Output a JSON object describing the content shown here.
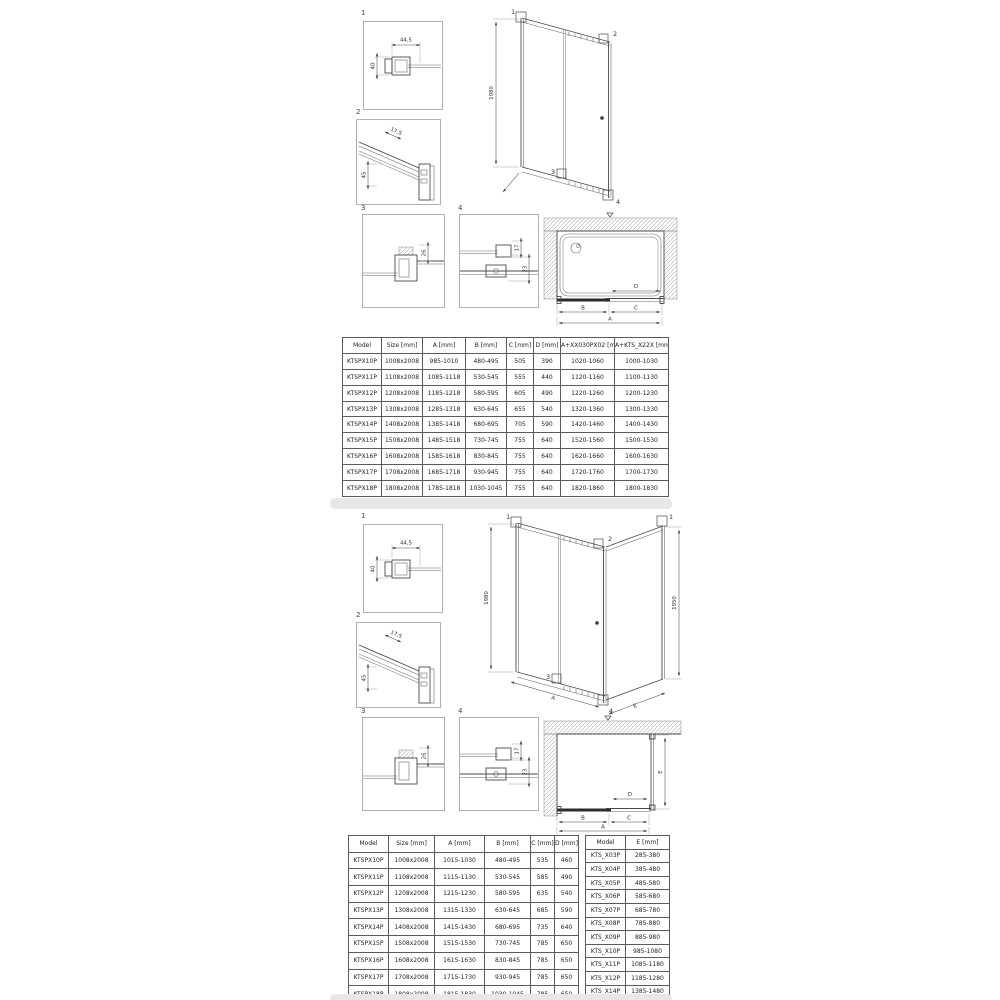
{
  "top_section": {
    "details": {
      "d1": {
        "label": "1",
        "dim_width": "44,5",
        "dim_height": "40"
      },
      "d2": {
        "label": "2",
        "dim_diag": "17,5",
        "dim_side": "45"
      },
      "d3": {
        "label": "3",
        "dim": "26"
      },
      "d4": {
        "label": "4",
        "dim_top": "17",
        "dim_bottom": "23"
      }
    },
    "elevation": {
      "height_label": "1980",
      "callout1": "1",
      "callout2": "2",
      "callout3": "3",
      "callout4": "4"
    },
    "plan": {
      "dim_a": "A",
      "dim_b": "B",
      "dim_c": "C",
      "dim_d": "D"
    },
    "table": {
      "headers": [
        "Model",
        "Size [mm]",
        "A [mm]",
        "B [mm]",
        "C [mm]",
        "D [mm]",
        "A+XX030PX02 [mm]",
        "A+KTS_X22X [mm]"
      ],
      "rows": [
        [
          "KTSPX10P",
          "1008x2008",
          "985-1010",
          "480-495",
          "505",
          "390",
          "1020-1060",
          "1000-1030"
        ],
        [
          "KTSPX11P",
          "1108x2008",
          "1085-1118",
          "530-545",
          "555",
          "440",
          "1120-1160",
          "1100-1130"
        ],
        [
          "KTSPX12P",
          "1208x2008",
          "1185-1218",
          "580-595",
          "605",
          "490",
          "1220-1260",
          "1200-1230"
        ],
        [
          "KTSPX13P",
          "1308x2008",
          "1285-1318",
          "630-645",
          "655",
          "540",
          "1320-1360",
          "1300-1330"
        ],
        [
          "KTSPX14P",
          "1408x2008",
          "1385-1418",
          "680-695",
          "705",
          "590",
          "1420-1460",
          "1400-1430"
        ],
        [
          "KTSPX15P",
          "1508x2008",
          "1485-1518",
          "730-745",
          "755",
          "640",
          "1520-1560",
          "1500-1530"
        ],
        [
          "KTSPX16P",
          "1608x2008",
          "1585-1618",
          "830-845",
          "755",
          "640",
          "1620-1660",
          "1600-1630"
        ],
        [
          "KTSPX17P",
          "1708x2008",
          "1685-1718",
          "930-945",
          "755",
          "640",
          "1720-1760",
          "1700-1730"
        ],
        [
          "KTSPX18P",
          "1808x2008",
          "1785-1818",
          "1030-1045",
          "755",
          "640",
          "1820-1860",
          "1800-1830"
        ]
      ]
    }
  },
  "bottom_section": {
    "details": {
      "d1": {
        "label": "1",
        "dim_width": "44,5",
        "dim_height": "40"
      },
      "d2": {
        "label": "2",
        "dim_diag": "17,5",
        "dim_side": "45"
      },
      "d3": {
        "label": "3",
        "dim": "26"
      },
      "d4": {
        "label": "4",
        "dim_top": "17",
        "dim_bottom": "23"
      }
    },
    "elevation": {
      "height_label": "1980",
      "panel_height_label": "1950",
      "callout1": "1",
      "callout1b": "1",
      "callout2": "2",
      "callout3": "3",
      "callout4": "4",
      "dim_a": "A",
      "dim_e": "E"
    },
    "plan": {
      "dim_a": "A",
      "dim_b": "B",
      "dim_c": "C",
      "dim_d": "D",
      "dim_e": "E"
    },
    "table": {
      "headers": [
        "Model",
        "Size [mm]",
        "A [mm]",
        "B [mm]",
        "C [mm]",
        "D [mm]"
      ],
      "rows": [
        [
          "KTSPX10P",
          "1008x2008",
          "1015-1030",
          "480-495",
          "535",
          "460"
        ],
        [
          "KTSPX11P",
          "1108x2008",
          "1115-1130",
          "530-545",
          "585",
          "490"
        ],
        [
          "KTSPX12P",
          "1208x2008",
          "1215-1230",
          "580-595",
          "635",
          "540"
        ],
        [
          "KTSPX13P",
          "1308x2008",
          "1315-1330",
          "630-645",
          "685",
          "590"
        ],
        [
          "KTSPX14P",
          "1408x2008",
          "1415-1430",
          "680-695",
          "735",
          "640"
        ],
        [
          "KTSPX15P",
          "1508x2008",
          "1515-1530",
          "730-745",
          "785",
          "650"
        ],
        [
          "KTSPX16P",
          "1608x2008",
          "1615-1630",
          "830-845",
          "785",
          "650"
        ],
        [
          "KTSPX17P",
          "1708x2008",
          "1715-1730",
          "930-945",
          "785",
          "650"
        ],
        [
          "KTSPX18P",
          "1808x2008",
          "1815-1830",
          "1030-1045",
          "785",
          "650"
        ]
      ]
    },
    "table_e": {
      "headers": [
        "Model",
        "E [mm]"
      ],
      "rows": [
        [
          "KTS_X03P",
          "285-380"
        ],
        [
          "KTS_X04P",
          "385-480"
        ],
        [
          "KTS_X05P",
          "485-580"
        ],
        [
          "KTS_X06P",
          "585-680"
        ],
        [
          "KTS_X07P",
          "685-780"
        ],
        [
          "KTS_X08P",
          "785-880"
        ],
        [
          "KTS_X09P",
          "885-980"
        ],
        [
          "KTS_X10P",
          "985-1080"
        ],
        [
          "KTS_X11P",
          "1085-1180"
        ],
        [
          "KTS_X12P",
          "1185-1280"
        ],
        [
          "KTS_X14P",
          "1385-1480"
        ]
      ]
    }
  }
}
